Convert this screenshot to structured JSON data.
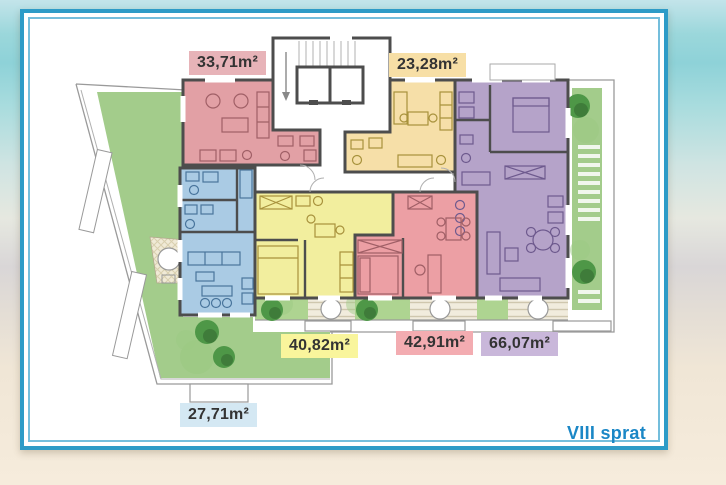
{
  "floor_plan": {
    "floor_label": "VIII sprat",
    "apartments": [
      {
        "id": "top-left",
        "area": "33,71m²"
      },
      {
        "id": "top-right",
        "area": "23,28m²"
      },
      {
        "id": "bottom-middle-left",
        "area": "40,82m²"
      },
      {
        "id": "bottom-middle-right",
        "area": "42,91m²"
      },
      {
        "id": "right",
        "area": "66,07m²"
      },
      {
        "id": "bottom-left",
        "area": "27,71m²"
      }
    ],
    "colors": {
      "apartment_pink_top": "#e2a0a5",
      "apartment_yellow_top": "#f6dfa8",
      "apartment_yellow_bottom": "#f2ee9e",
      "apartment_pink_bottom": "#ec9fa4",
      "apartment_purple": "#b5a3c9",
      "apartment_blue": "#aacbe4",
      "terrace_green": "#a3cc8b",
      "frame_blue": "#2d9bc7",
      "floor_label_blue": "#1b87c6",
      "wall_gray": "#4d4d4d"
    }
  }
}
